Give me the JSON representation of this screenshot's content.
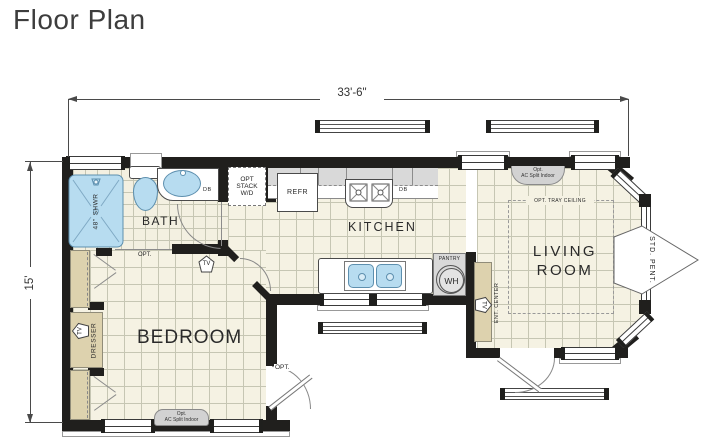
{
  "title": "Floor Plan",
  "dimensions": {
    "width": "33'-6\"",
    "depth": "15'"
  },
  "rooms": {
    "bath": "BATH",
    "kitchen": "KITCHEN",
    "bedroom": "BEDROOM",
    "living_line1": "LIVING",
    "living_line2": "ROOM"
  },
  "fixtures": {
    "shower_size": "48\"",
    "shower": "SHWR",
    "washer_dryer": {
      "line1": "OPT",
      "line2": "STACK",
      "line3": "W/D"
    },
    "refrigerator": "REFR",
    "disposal_bath": "DB",
    "disposal_kitchen": "DB",
    "pantry": "PANTRY",
    "water_heater": "WH",
    "dresser": "DRESSER",
    "ent_center": "ENT. CENTER",
    "tv": "TV"
  },
  "annotations": {
    "ac_split_line1": "Opt.",
    "ac_split_line2": "AC Split Indoor",
    "tray_ceiling": "OPT. TRAY CEILING",
    "std_pent": "STD. PENT.",
    "opt_door_bath": "OPT.",
    "opt_door_bedroom": "OPT."
  },
  "colors": {
    "wall": "#201f1d",
    "floor": "#f5f2e3",
    "grid_line": "#c6c6b3",
    "fixture_blue": "#b7dcf0",
    "cabinet_tan": "#ddd2ae",
    "counter_gray": "#d9d9d9",
    "dimension": "#4a4a4a",
    "title_text": "#3d3d3d"
  }
}
